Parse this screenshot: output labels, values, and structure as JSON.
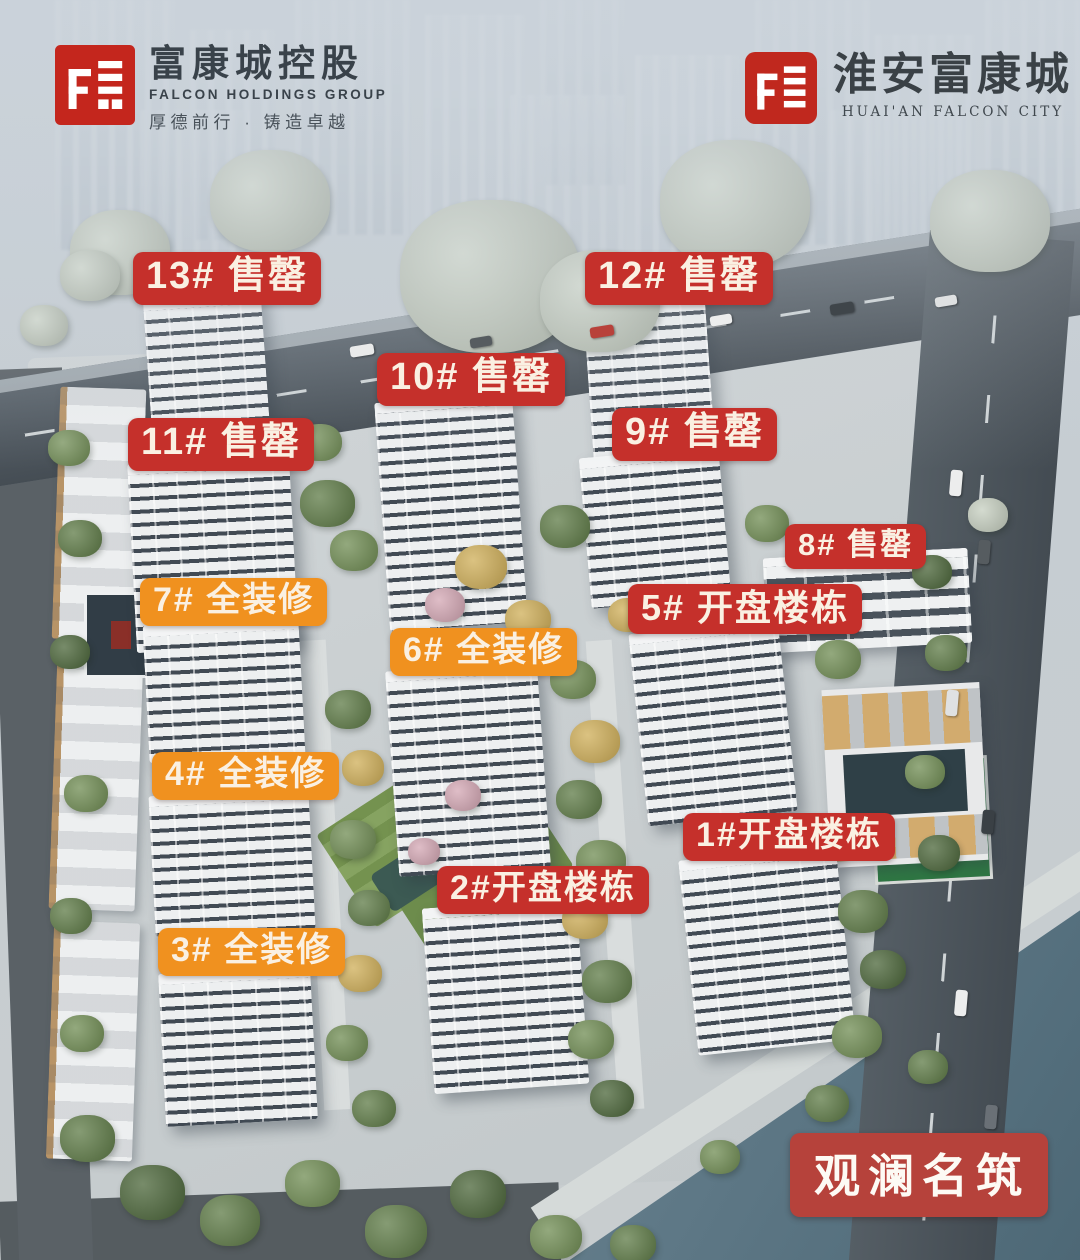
{
  "header": {
    "left_logo": {
      "cn": "富康城控股",
      "en": "FALCON  HOLDINGS  GROUP",
      "slogan": "厚德前行 · 铸造卓越"
    },
    "right_logo": {
      "cn": "淮安富康城",
      "en": "HUAI'AN  FALCON  CITY"
    }
  },
  "colors": {
    "sold_label": "#c5302b",
    "furnished_label": "#f0911f",
    "plaque": "#b6423b",
    "label_text": "#faf0e2",
    "logo_red": "#c4261d"
  },
  "labels": [
    {
      "id": "13",
      "text": "13# 售罄",
      "type": "sold",
      "x": 133,
      "y": 252,
      "fs": 38
    },
    {
      "id": "12",
      "text": "12# 售罄",
      "type": "sold",
      "x": 585,
      "y": 252,
      "fs": 38
    },
    {
      "id": "10",
      "text": "10# 售罄",
      "type": "sold",
      "x": 377,
      "y": 353,
      "fs": 38
    },
    {
      "id": "11",
      "text": "11# 售罄",
      "type": "sold",
      "x": 128,
      "y": 418,
      "fs": 38
    },
    {
      "id": "9",
      "text": "9# 售罄",
      "type": "sold",
      "x": 612,
      "y": 408,
      "fs": 38
    },
    {
      "id": "8",
      "text": "8# 售罄",
      "type": "sold",
      "x": 785,
      "y": 524,
      "fs": 31
    },
    {
      "id": "7",
      "text": "7# 全装修",
      "type": "furnished",
      "x": 140,
      "y": 578,
      "fs": 34
    },
    {
      "id": "5",
      "text": "5# 开盘楼栋",
      "type": "sold",
      "x": 628,
      "y": 584,
      "fs": 36
    },
    {
      "id": "6",
      "text": "6# 全装修",
      "type": "furnished",
      "x": 390,
      "y": 628,
      "fs": 34
    },
    {
      "id": "4",
      "text": "4# 全装修",
      "type": "furnished",
      "x": 152,
      "y": 752,
      "fs": 34
    },
    {
      "id": "1",
      "text": "1#开盘楼栋",
      "type": "sold",
      "x": 683,
      "y": 813,
      "fs": 34
    },
    {
      "id": "2",
      "text": "2#开盘楼栋",
      "type": "sold",
      "x": 437,
      "y": 866,
      "fs": 34
    },
    {
      "id": "3",
      "text": "3# 全装修",
      "type": "furnished",
      "x": 158,
      "y": 928,
      "fs": 34
    }
  ],
  "plaque": {
    "text": "观澜名筑"
  }
}
